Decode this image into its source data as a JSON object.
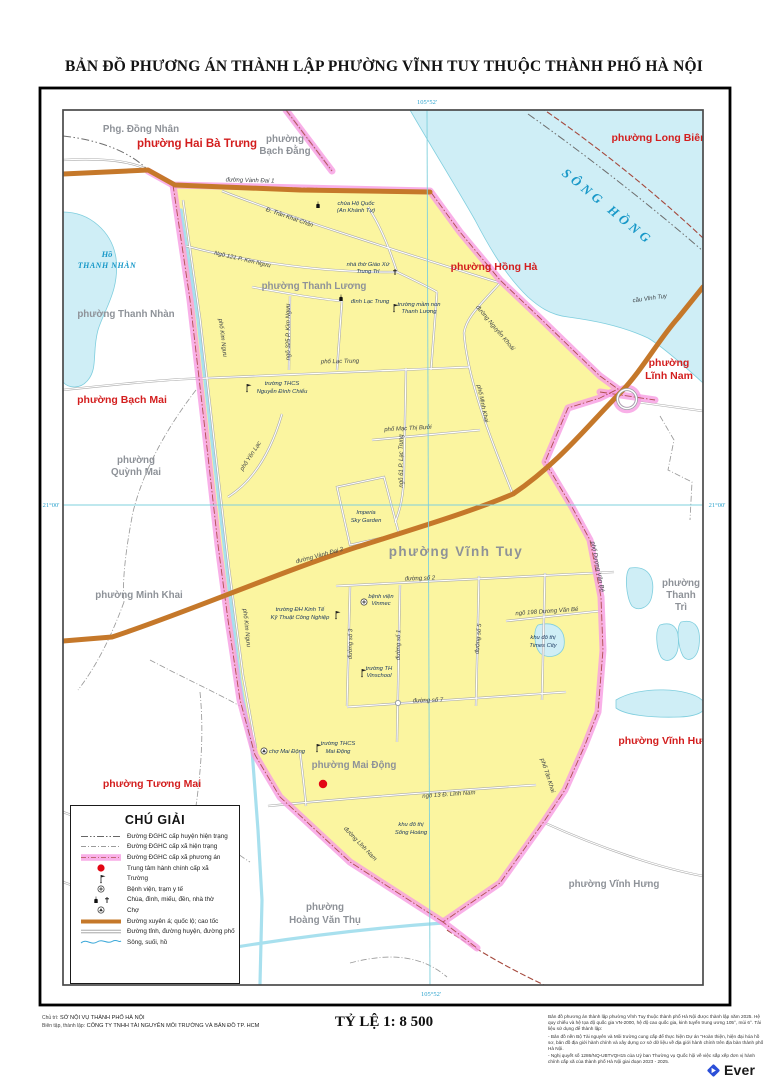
{
  "title": "BẢN ĐỒ PHƯƠNG ÁN THÀNH LẬP PHƯỜNG VĨNH TUY THUỘC THÀNH PHỐ HÀ NỘI",
  "coords": {
    "top": "105°52'",
    "bottom": "105°52'",
    "left": "21°00'",
    "right": "21°00'"
  },
  "water": {
    "river": "SÔNG  HỒNG",
    "lake_1": "Hồ",
    "lake_2": "THANH NHÀN"
  },
  "wards_red": {
    "hai_ba_trung": "phường Hai Bà Trưng",
    "long_bien": "phường Long Biên",
    "hong_ha": "phường Hồng Hà",
    "linh_nam_1": "phường",
    "linh_nam_2": "Lĩnh Nam",
    "bach_mai": "phường Bạch Mai",
    "tuong_mai": "phường Tương Mai",
    "vinh_hung": "phường Vĩnh Hưng"
  },
  "wards_gray": {
    "dong_nhan": "Phg. Đồng Nhân",
    "bach_dang_1": "phường",
    "bach_dang_2": "Bạch Đằng",
    "thanh_nhan": "phường Thanh Nhàn",
    "thanh_luong": "phường Thanh Lương",
    "quynh_mai_1": "phường",
    "quynh_mai_2": "Quỳnh Mai",
    "minh_khai": "phường Minh Khai",
    "vinh_tuy": "phường Vĩnh Tuy",
    "thanh_tri_1": "phường",
    "thanh_tri_2": "Thanh",
    "thanh_tri_3": "Trì",
    "mai_dong": "phường Mai Động",
    "hoang_van_thu_1": "phường",
    "hoang_van_thu_2": "Hoàng Văn Thụ",
    "vinh_hung": "phường Vĩnh Hưng"
  },
  "streets": {
    "vanh_dai_1": "đường Vành Đai 1",
    "tran_khat_chan": "Đ. Trần Khát Chân",
    "ngo_121": "Ngõ 121 P. Kim Ngưu",
    "kim_nguu": "phố Kim Ngưu",
    "ngo_325": "ngõ 325 P. Kim Ngưu",
    "lac_trung": "phố Lạc Trung",
    "nguyen_khoai": "đường Nguyễn Khoái",
    "minh_khai": "phố Minh Khai",
    "ngo_61": "ngõ 61 P. Lạc Trung",
    "mac_thi_buoi": "phố Mạc Thị Bưởi",
    "yen_lac": "phố Yên Lạc",
    "vanh_dai_2": "đường Vành Đai 2",
    "so_2": "đường số 2",
    "so_3": "đường số 3",
    "so_1": "đường số 1",
    "so_5": "đường số 5",
    "so_7": "đường số 7",
    "ngo_198": "ngõ 198 Dương Văn Bé",
    "duong_van_be": "phố Dương Văn Bé",
    "ngo_13": "ngõ 13 Đ. Lĩnh Nam",
    "linh_nam": "đường Lĩnh Nam",
    "tan_khai": "phố Tân Khai",
    "cau_vinh_tuy": "cầu Vĩnh Tuy"
  },
  "pois": {
    "chua_1": "chùa Hộ Quốc",
    "chua_2": "(An Khánh Tự)",
    "nha_tho_1": "nhà thờ Giáo Xứ",
    "nha_tho_2": "Trung Trí",
    "dinh": "đình Lạc Trung",
    "mam_non_1": "trường mầm non",
    "mam_non_2": "Thanh Lương",
    "thcs_ndc_1": "trường THCS",
    "thcs_ndc_2": "Nguyễn Đình Chiểu",
    "imperia_1": "Imperia",
    "imperia_2": "Sky Garden",
    "vinmec_1": "bệnh viện",
    "vinmec_2": "Vinmec",
    "dh_1": "trường ĐH Kinh Tế",
    "dh_2": "Kỹ Thuật Công Nghiệp",
    "vinschool_1": "trường TH",
    "vinschool_2": "Vinschool",
    "times_1": "khu đô thị",
    "times_2": "Times City",
    "cho": "chợ Mai Động",
    "thcs_md_1": "trường THCS",
    "thcs_md_2": "Mai Động",
    "song_hoang_1": "khu đô thị",
    "song_hoang_2": "Sống Hoàng"
  },
  "legend": {
    "title": "CHÚ GIẢI",
    "items": [
      "Đường ĐGHC cấp huyện hiện trạng",
      "Đường ĐGHC cấp xã hiện trạng",
      "Đường ĐGHC cấp xã phương án",
      "Trung tâm hành chính cấp xã",
      "Trường",
      "Bệnh viện, trạm y tế",
      "Chùa, đình, miếu, đền, nhà thờ",
      "Chợ",
      "Đường xuyên á; quốc lộ; cao tốc",
      "Đường tỉnh, đường huyện, đường phố",
      "Sông, suối, hồ"
    ]
  },
  "scale": "TỶ LỆ 1: 8 500",
  "credits": {
    "l1_label": "Chủ trì:",
    "l1": "SỞ NỘI VỤ THÀNH PHỐ HÀ NỘI",
    "l2_label": "Biên tập, thành lập:",
    "l2": "CÔNG TY TNHH TÀI NGUYÊN MÔI TRƯỜNG VÀ BẢN ĐỒ TP. HCM"
  },
  "notes": {
    "p1": "Bản đồ phương án thành lập phường Vĩnh Tuy thuộc thành phố Hà Nội được thành lập năm 2025. Hệ quy chiếu và hệ tọa độ quốc gia VN-2000, hệ độ cao quốc gia, kinh tuyến trung ương 105°, múi 6°. Tài liệu sử dụng để thành lập:",
    "p2": "- Bản đồ nền Bộ Tài nguyên và Môi trường cung cấp để thực hiện Dự án \"Hoàn thiện, hiện đại hóa hồ sơ, bản đồ địa giới hành chính và xây dựng cơ sở dữ liệu về địa giới hành chính trên địa bàn thành phố Hà Nội.",
    "p3": "- Nghị quyết số 1286/NQ-UBTVQH15 của Uỷ ban Thường vụ Quốc hội về việc sắp xếp đơn vị hành chính cấp xã của thành phố Hà Nội giai đoạn 2023 - 2025."
  },
  "brand": "Ever",
  "colors": {
    "ward_area": "#fbf5a0",
    "boundary_pink": "#f79ce2",
    "highway": "#c5782a",
    "water_fill": "#cfeef6",
    "red_label": "#d31e1e",
    "gray_label": "#8e9298",
    "water_label": "#1898c8"
  }
}
